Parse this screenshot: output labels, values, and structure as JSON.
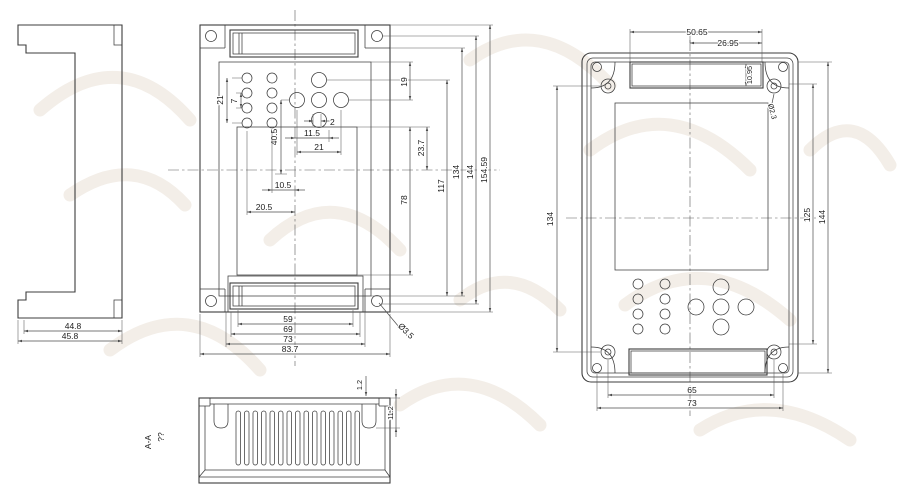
{
  "title": "enclosure-technical-drawing",
  "colors": {
    "object_line": "#3c3c3c",
    "dimension_line": "#4c4c4c",
    "centerline": "#5a5a5a",
    "watermark": "#f3eee8",
    "background": "#ffffff"
  },
  "side_view": {
    "dim_inner_width": "44.8",
    "dim_outer_width": "45.8"
  },
  "front_view": {
    "dim_btn_rows": "21",
    "dim_btn_pitch": "7",
    "dim_keypad_drop": "40.5",
    "dim_btn_offset": "2",
    "dim_btn_half_span": "11.5",
    "dim_btn_span": "21",
    "dim_col2_center": "10.5",
    "dim_col1_center": "20.5",
    "dim_w1": "59",
    "dim_w2": "69",
    "dim_w3": "73",
    "dim_w4": "83.7",
    "dim_ear_hole": "Ø3.5",
    "dim_h1": "19",
    "dim_h2": "23.7",
    "dim_h3": "117",
    "dim_h4": "78",
    "dim_h5": "134",
    "dim_h6": "144",
    "dim_h7": "154.59"
  },
  "back_view": {
    "dim_slot_w": "50.65",
    "dim_slot_half": "26.95",
    "dim_slot_h": "10.95",
    "dim_boss_hole": "Ø2.3",
    "dim_h_left": "134",
    "dim_h_inner": "125",
    "dim_h_outer": "144",
    "dim_w_boss": "65",
    "dim_w_hole": "73"
  },
  "section_view": {
    "label_prefix": "??",
    "label": "A-A",
    "dim_wall": "1.2",
    "dim_post": "11.2"
  }
}
